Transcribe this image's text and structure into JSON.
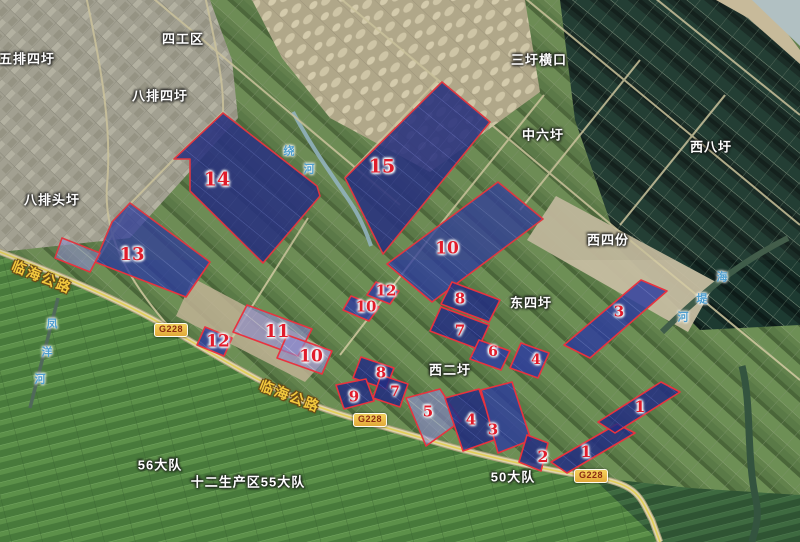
{
  "map": {
    "parcel_numbers": [
      {
        "label": "14",
        "x": 217,
        "y": 180,
        "size": 19
      },
      {
        "label": "15",
        "x": 382,
        "y": 167,
        "size": 19
      },
      {
        "label": "13",
        "x": 132,
        "y": 255,
        "size": 18
      },
      {
        "label": "10",
        "x": 447,
        "y": 249,
        "size": 17
      },
      {
        "label": "12",
        "x": 386,
        "y": 291,
        "size": 15
      },
      {
        "label": "10",
        "x": 366,
        "y": 307,
        "size": 15
      },
      {
        "label": "8",
        "x": 460,
        "y": 299,
        "size": 15
      },
      {
        "label": "7",
        "x": 460,
        "y": 331,
        "size": 15
      },
      {
        "label": "6",
        "x": 493,
        "y": 352,
        "size": 14
      },
      {
        "label": "4",
        "x": 536,
        "y": 360,
        "size": 14
      },
      {
        "label": "3",
        "x": 619,
        "y": 312,
        "size": 15
      },
      {
        "label": "11",
        "x": 277,
        "y": 332,
        "size": 18
      },
      {
        "label": "12",
        "x": 218,
        "y": 342,
        "size": 17
      },
      {
        "label": "10",
        "x": 311,
        "y": 357,
        "size": 17
      },
      {
        "label": "8",
        "x": 381,
        "y": 373,
        "size": 15
      },
      {
        "label": "9",
        "x": 354,
        "y": 397,
        "size": 15
      },
      {
        "label": "7",
        "x": 395,
        "y": 392,
        "size": 14
      },
      {
        "label": "5",
        "x": 428,
        "y": 412,
        "size": 15
      },
      {
        "label": "4",
        "x": 471,
        "y": 420,
        "size": 15
      },
      {
        "label": "3",
        "x": 493,
        "y": 430,
        "size": 15
      },
      {
        "label": "2",
        "x": 543,
        "y": 457,
        "size": 16
      },
      {
        "label": "1",
        "x": 586,
        "y": 452,
        "size": 16
      },
      {
        "label": "1",
        "x": 640,
        "y": 407,
        "size": 16
      }
    ],
    "place_labels": [
      {
        "name": "五排四圩",
        "x": 27,
        "y": 59
      },
      {
        "name": "四工区",
        "x": 183,
        "y": 39
      },
      {
        "name": "八排四圩",
        "x": 160,
        "y": 96
      },
      {
        "name": "三圩横口",
        "x": 539,
        "y": 60
      },
      {
        "name": "中六圩",
        "x": 543,
        "y": 135
      },
      {
        "name": "西八圩",
        "x": 711,
        "y": 147
      },
      {
        "name": "八排头圩",
        "x": 52,
        "y": 200
      },
      {
        "name": "西四份",
        "x": 608,
        "y": 240
      },
      {
        "name": "东四圩",
        "x": 531,
        "y": 303
      },
      {
        "name": "西二圩",
        "x": 450,
        "y": 370
      },
      {
        "name": "56大队",
        "x": 160,
        "y": 465
      },
      {
        "name": "十二生产区55大队",
        "x": 248,
        "y": 482
      },
      {
        "name": "50大队",
        "x": 513,
        "y": 477
      }
    ],
    "road_shields": [
      {
        "label": "G228",
        "x": 171,
        "y": 330
      },
      {
        "label": "G228",
        "x": 370,
        "y": 420
      },
      {
        "label": "G228",
        "x": 591,
        "y": 476
      }
    ],
    "road_name_labels": [
      {
        "name": "临海公路",
        "x": 42,
        "y": 277,
        "rotation": 22
      },
      {
        "name": "临海公路",
        "x": 290,
        "y": 396,
        "rotation": 21
      }
    ],
    "water_labels": [
      {
        "name": "绕河",
        "chars": [
          {
            "ch": "绕",
            "x": 289,
            "y": 152
          },
          {
            "ch": "河",
            "x": 309,
            "y": 170
          }
        ]
      },
      {
        "name": "海堤河",
        "chars": [
          {
            "ch": "海",
            "x": 722,
            "y": 278
          },
          {
            "ch": "堤",
            "x": 702,
            "y": 300
          },
          {
            "ch": "河",
            "x": 683,
            "y": 318
          }
        ]
      },
      {
        "name": "凤洋河",
        "chars": [
          {
            "ch": "凤",
            "x": 52,
            "y": 325
          },
          {
            "ch": "洋",
            "x": 47,
            "y": 353
          },
          {
            "ch": "河",
            "x": 40,
            "y": 380
          }
        ]
      }
    ],
    "colors": {
      "parcel_stroke": "#e8333f",
      "parcel_navy": "#222c82",
      "parcel_blue": "#2c3b9e",
      "parcel_violet": "#8a88cf",
      "number_red": "#e11c2b",
      "road_name_yellow": "#f2c83e",
      "shield_yellow": "#f6d35c"
    }
  }
}
